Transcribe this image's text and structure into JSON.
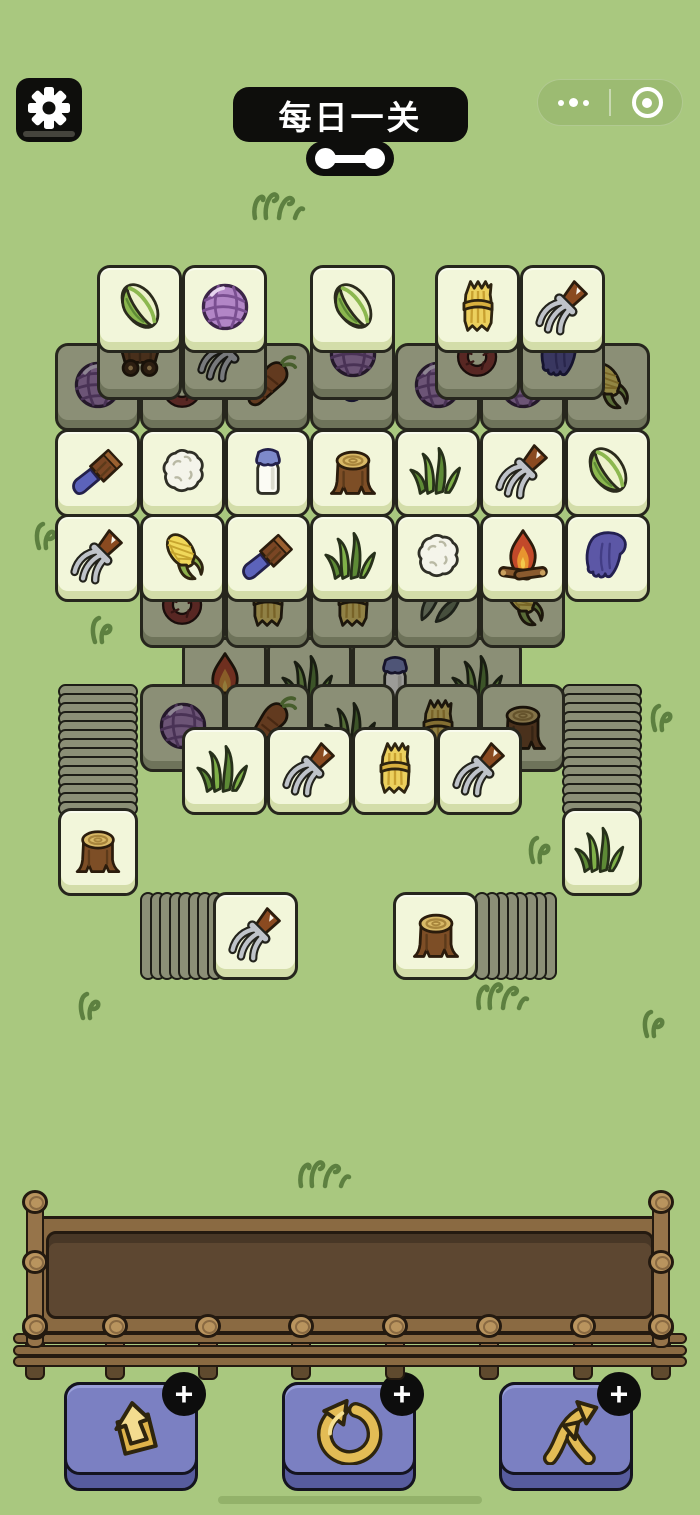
{
  "header": {
    "title": "每日一关",
    "settings_icon": "gear-icon",
    "connector_icon": "dumbbell-icon",
    "capsule": {
      "more_icon": "ellipsis-icon",
      "record_icon": "record-icon"
    }
  },
  "colors": {
    "background": "#a9c87f",
    "tile_face": "#f2f6da",
    "tile_shaded": "#8b8f76",
    "tray_brown": "#5d4731",
    "button_purple": "#7b80c2",
    "gold": "#e3bc55",
    "pill_black": "#0e0e0c"
  },
  "board": {
    "tile_w": 85,
    "tile_h": 88,
    "groups": [
      {
        "name": "back-row-upper",
        "type": "shaded",
        "z": 25,
        "y": 312,
        "tiles": [
          {
            "x": 97,
            "icon": "cart"
          },
          {
            "x": 182,
            "icon": "pitchfork"
          },
          {
            "x": 310,
            "icon": "yarn"
          },
          {
            "x": 435,
            "icon": "rope"
          },
          {
            "x": 520,
            "icon": "glove"
          }
        ]
      },
      {
        "name": "top-row",
        "type": "bright",
        "z": 30,
        "y": 265,
        "tiles": [
          {
            "x": 97,
            "icon": "cabbage"
          },
          {
            "x": 182,
            "icon": "yarn"
          },
          {
            "x": 310,
            "icon": "cabbage"
          },
          {
            "x": 435,
            "icon": "hay"
          },
          {
            "x": 520,
            "icon": "pitchfork"
          }
        ]
      },
      {
        "name": "back-row-wide",
        "type": "shaded",
        "z": 20,
        "y": 343,
        "tiles": [
          {
            "x": 55,
            "icon": "yarn"
          },
          {
            "x": 140,
            "icon": "rope"
          },
          {
            "x": 225,
            "icon": "carrot"
          },
          {
            "x": 310,
            "icon": "mushroom"
          },
          {
            "x": 395,
            "icon": "yarn"
          },
          {
            "x": 480,
            "icon": "yarn"
          },
          {
            "x": 565,
            "icon": "corn"
          }
        ]
      },
      {
        "name": "mid-row-1",
        "type": "bright",
        "z": 30,
        "y": 429,
        "tiles": [
          {
            "x": 55,
            "icon": "brush"
          },
          {
            "x": 140,
            "icon": "cauliflower"
          },
          {
            "x": 225,
            "icon": "milk"
          },
          {
            "x": 310,
            "icon": "stump"
          },
          {
            "x": 395,
            "icon": "grass"
          },
          {
            "x": 480,
            "icon": "pitchfork"
          },
          {
            "x": 565,
            "icon": "cabbage"
          }
        ]
      },
      {
        "name": "mid-row-2",
        "type": "bright",
        "z": 30,
        "y": 514,
        "tiles": [
          {
            "x": 55,
            "icon": "pitchfork"
          },
          {
            "x": 140,
            "icon": "corn"
          },
          {
            "x": 225,
            "icon": "brush"
          },
          {
            "x": 310,
            "icon": "grass"
          },
          {
            "x": 395,
            "icon": "cauliflower"
          },
          {
            "x": 480,
            "icon": "campfire"
          },
          {
            "x": 565,
            "icon": "glove"
          }
        ]
      },
      {
        "name": "back-row-3",
        "type": "shaded",
        "z": 16,
        "y": 560,
        "tiles": [
          {
            "x": 140,
            "icon": "rope"
          },
          {
            "x": 225,
            "icon": "hay"
          },
          {
            "x": 310,
            "icon": "hay"
          },
          {
            "x": 395,
            "icon": "leaf"
          },
          {
            "x": 480,
            "icon": "corn"
          }
        ]
      },
      {
        "name": "back-row-4",
        "type": "shaded",
        "z": 12,
        "y": 637,
        "tiles": [
          {
            "x": 182,
            "icon": "campfire"
          },
          {
            "x": 267,
            "icon": "grass"
          },
          {
            "x": 352,
            "icon": "milk"
          },
          {
            "x": 437,
            "icon": "grass"
          }
        ]
      },
      {
        "name": "back-row-5",
        "type": "shaded",
        "z": 14,
        "y": 684,
        "tiles": [
          {
            "x": 140,
            "icon": "yarn"
          },
          {
            "x": 225,
            "icon": "carrot"
          },
          {
            "x": 310,
            "icon": "grass"
          },
          {
            "x": 395,
            "icon": "hay"
          },
          {
            "x": 480,
            "icon": "stump"
          }
        ]
      },
      {
        "name": "front-row",
        "type": "bright",
        "z": 18,
        "y": 727,
        "tiles": [
          {
            "x": 182,
            "icon": "grass"
          },
          {
            "x": 267,
            "icon": "pitchfork"
          },
          {
            "x": 352,
            "icon": "hay"
          },
          {
            "x": 437,
            "icon": "pitchfork"
          }
        ]
      }
    ],
    "side_stacks": [
      {
        "name": "left-stack",
        "x": 58,
        "strip_y": 684,
        "strip_count": 14,
        "face": {
          "icon": "stump",
          "y": 808
        }
      },
      {
        "name": "right-stack",
        "x": 562,
        "strip_y": 684,
        "strip_count": 14,
        "face": {
          "icon": "grass",
          "y": 808
        }
      }
    ],
    "bottom_stacks": [
      {
        "name": "bottom-left-stack",
        "face_x": 213,
        "y": 892,
        "icon": "pitchfork",
        "strips_x": 140,
        "strip_count": 8,
        "dir": "left"
      },
      {
        "name": "bottom-right-stack",
        "face_x": 393,
        "y": 892,
        "icon": "stump",
        "strips_x": 474,
        "strip_count": 8,
        "dir": "right"
      }
    ]
  },
  "tray": {
    "side_posts_x": [
      26,
      652
    ],
    "side_knob_ys": [
      1190,
      1250,
      1316
    ],
    "bottom_posts_cx": [
      115,
      208,
      301,
      395,
      489,
      583
    ],
    "rail_ys": [
      1333,
      1345,
      1356
    ]
  },
  "powerups": [
    {
      "name": "eject",
      "icon": "eject-icon",
      "badge": "+",
      "x": 64
    },
    {
      "name": "undo",
      "icon": "undo-icon",
      "badge": "+",
      "x": 282
    },
    {
      "name": "shuffle",
      "icon": "shuffle-icon",
      "badge": "+",
      "x": 499
    }
  ],
  "decor": {
    "tufts": [
      {
        "x": 250,
        "y": 186,
        "variant": "clump"
      },
      {
        "x": 30,
        "y": 516,
        "variant": "sprout"
      },
      {
        "x": 86,
        "y": 610,
        "variant": "sprout"
      },
      {
        "x": 646,
        "y": 698,
        "variant": "sprout"
      },
      {
        "x": 524,
        "y": 830,
        "variant": "sprout"
      },
      {
        "x": 74,
        "y": 986,
        "variant": "sprout"
      },
      {
        "x": 474,
        "y": 976,
        "variant": "clump"
      },
      {
        "x": 638,
        "y": 1004,
        "variant": "sprout"
      },
      {
        "x": 296,
        "y": 1154,
        "variant": "clump"
      }
    ]
  }
}
